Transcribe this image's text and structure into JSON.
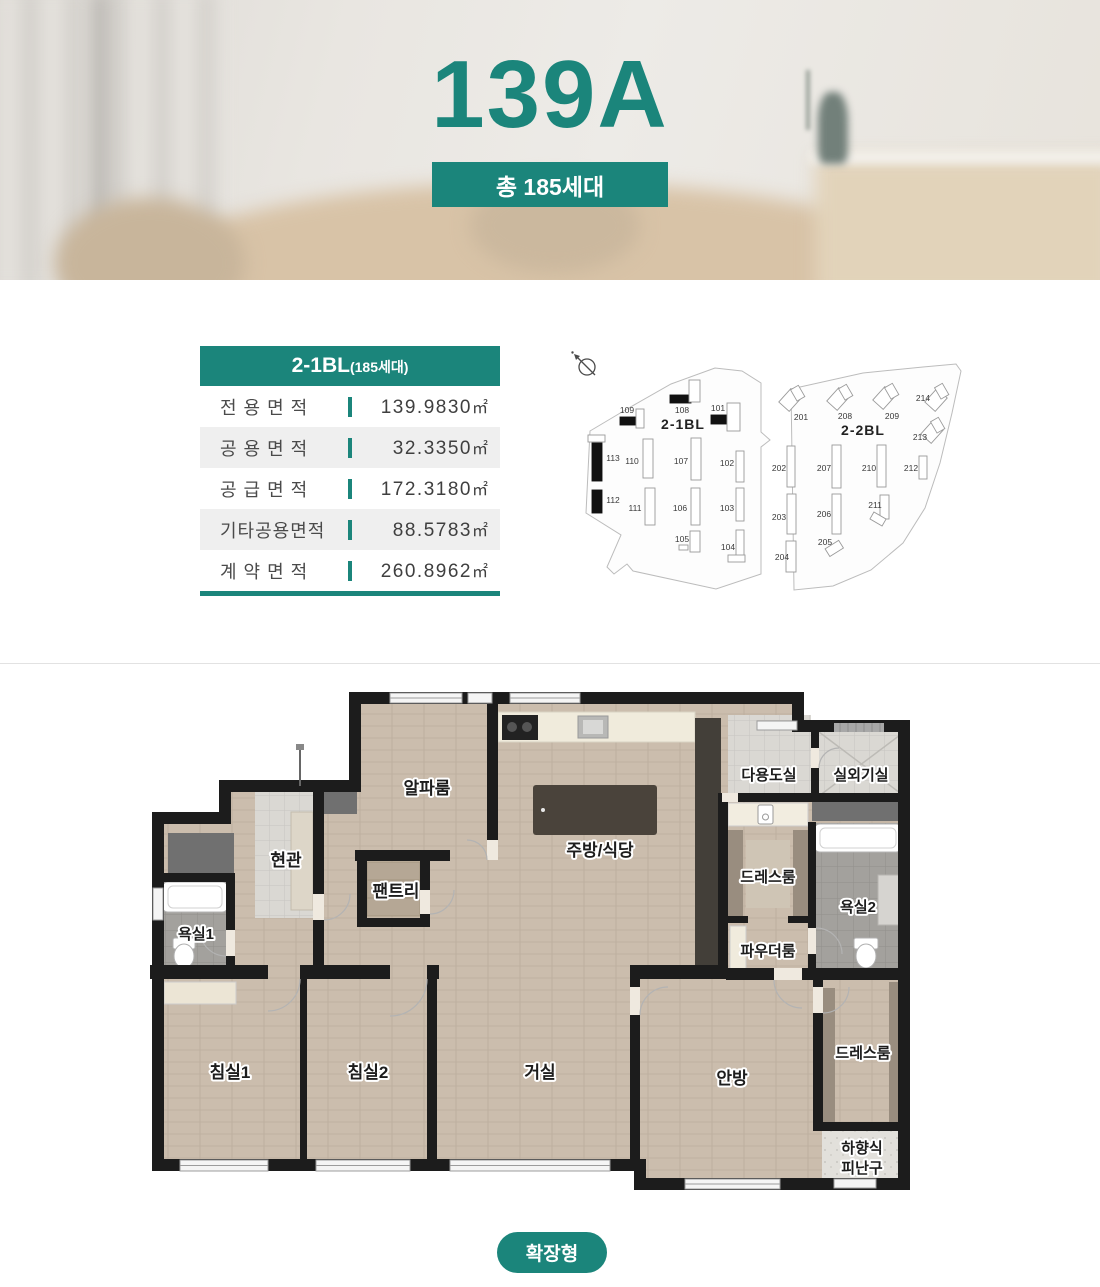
{
  "theme": {
    "accent_teal": "#1B857B",
    "wall_color": "#1c1c1c",
    "wood_floor": "#cbbdad"
  },
  "hero": {
    "title": "139A",
    "badge": "총 185세대"
  },
  "info_table": {
    "header": {
      "block": "2-1BL",
      "units": "(185세대)"
    },
    "rows": [
      {
        "label": "전 용 면 적",
        "value": "139.9830",
        "unit": "㎡"
      },
      {
        "label": "공 용 면 적",
        "value": "32.3350",
        "unit": "㎡"
      },
      {
        "label": "공 급 면 적",
        "value": "172.3180",
        "unit": "㎡"
      },
      {
        "label": "기타공용면적",
        "value": "88.5783",
        "unit": "㎡"
      },
      {
        "label": "계 약 면 적",
        "value": "260.8962",
        "unit": "㎡"
      }
    ]
  },
  "site_plan": {
    "compass": "compass-icon",
    "block1": {
      "name": "2-1BL",
      "buildings": [
        "101",
        "102",
        "103",
        "104",
        "105",
        "106",
        "107",
        "108",
        "109",
        "110",
        "111",
        "112",
        "113"
      ],
      "highlighted": [
        "101",
        "108",
        "109",
        "112",
        "113"
      ]
    },
    "block2": {
      "name": "2-2BL",
      "buildings": [
        "201",
        "202",
        "203",
        "204",
        "205",
        "206",
        "207",
        "208",
        "209",
        "210",
        "211",
        "212",
        "213",
        "214"
      ],
      "highlighted": []
    }
  },
  "floor_plan": {
    "type_badge": "확장형",
    "rooms": {
      "alpha": "알파룸",
      "kitchen": "주방/식당",
      "utility": "다용도실",
      "outdoor_unit": "실외기실",
      "entrance": "현관",
      "pantry": "팬트리",
      "bath1": "욕실1",
      "dress1": "드레스룸",
      "powder": "파우더룸",
      "bath2": "욕실2",
      "bed1": "침실1",
      "bed2": "침실2",
      "living": "거실",
      "master": "안방",
      "dress2": "드레스룸",
      "hatch_line1": "하향식",
      "hatch_line2": "피난구"
    }
  }
}
